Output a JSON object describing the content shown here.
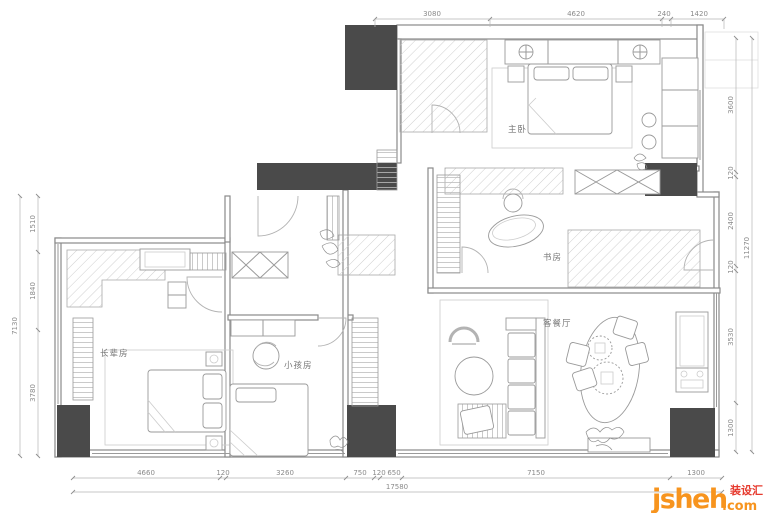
{
  "title": "apartment-floor-plan",
  "rooms": [
    {
      "id": "master-bedroom",
      "label": "主卧"
    },
    {
      "id": "study",
      "label": "书房"
    },
    {
      "id": "living-dining",
      "label": "客餐厅"
    },
    {
      "id": "kids-room",
      "label": "小孩房"
    },
    {
      "id": "elder-room",
      "label": "长辈房"
    }
  ],
  "dims": {
    "top": [
      "3080",
      "4620",
      "240",
      "1420"
    ],
    "bottom": [
      "4660",
      "120",
      "3260",
      "750",
      "120",
      "650",
      "7150",
      "1300"
    ],
    "bottom_total": "17580",
    "left": [
      "1510",
      "1840",
      "3780"
    ],
    "left_total": "7130",
    "right": [
      "3600",
      "120",
      "2400",
      "120",
      "3530",
      "1300"
    ],
    "right_total": "11270"
  },
  "watermark": {
    "site": "jsheh",
    "tld": ".com",
    "cn": "装设汇"
  },
  "colors": {
    "column": "#4a4a4a",
    "line": "#9a9a9a",
    "hatch": "#cfcfcf",
    "watermark_orange": "#f7941e",
    "watermark_red": "#e63a2e"
  }
}
